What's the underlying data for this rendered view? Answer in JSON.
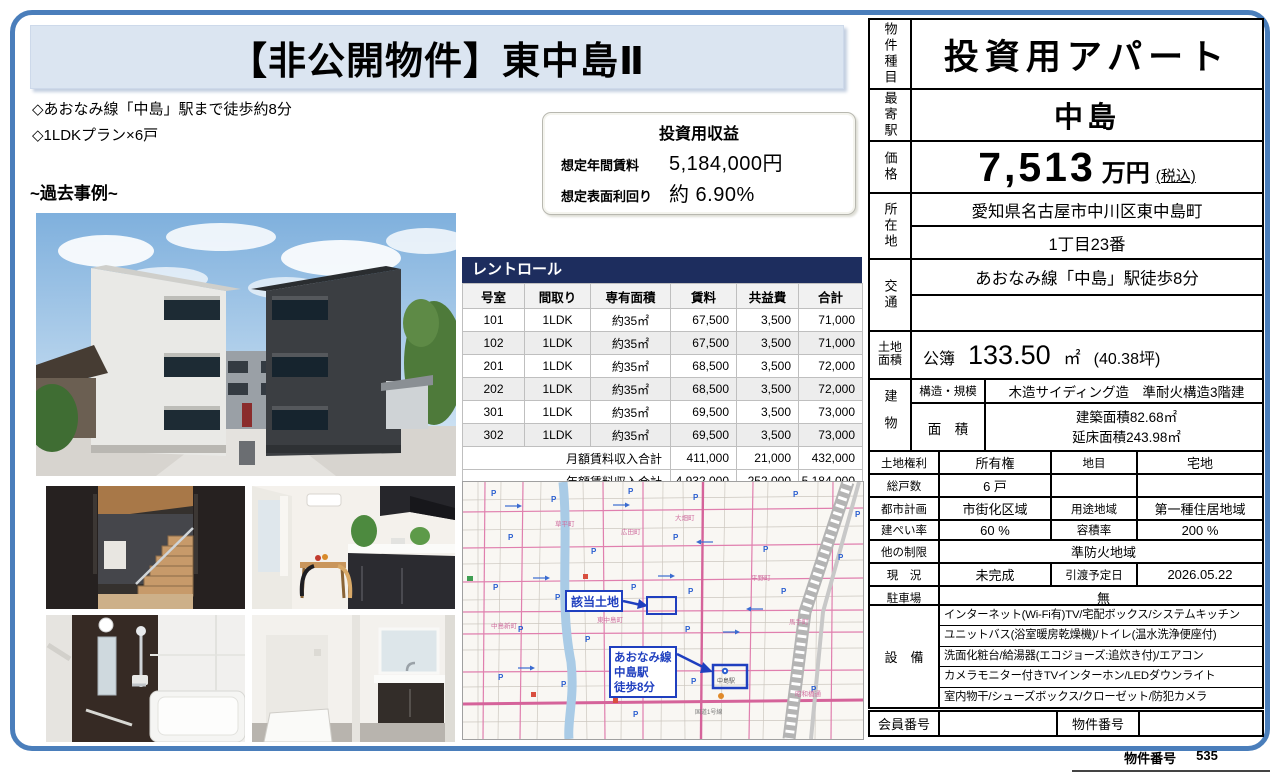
{
  "page": {
    "title": "【非公開物件】東中島Ⅱ",
    "bullets": [
      "◇あおなみ線「中島」駅まで徒歩約8分",
      "◇1LDKプラン×6戸"
    ],
    "past_example_heading": "~過去事例~",
    "footer_label": "物件番号",
    "footer_value": "535"
  },
  "income_box": {
    "title": "投資用収益",
    "annual_rent_label": "想定年間賃料",
    "annual_rent_value": "5,184,000円",
    "yield_label": "想定表面利回り",
    "yield_value": "約 6.90%"
  },
  "rent_roll": {
    "title": "レントロール",
    "columns": [
      "号室",
      "間取り",
      "専有面積",
      "賃料",
      "共益費",
      "合計"
    ],
    "rows": [
      [
        "101",
        "1LDK",
        "約35㎡",
        "67,500",
        "3,500",
        "71,000"
      ],
      [
        "102",
        "1LDK",
        "約35㎡",
        "67,500",
        "3,500",
        "71,000"
      ],
      [
        "201",
        "1LDK",
        "約35㎡",
        "68,500",
        "3,500",
        "72,000"
      ],
      [
        "202",
        "1LDK",
        "約35㎡",
        "68,500",
        "3,500",
        "72,000"
      ],
      [
        "301",
        "1LDK",
        "約35㎡",
        "69,500",
        "3,500",
        "73,000"
      ],
      [
        "302",
        "1LDK",
        "約35㎡",
        "69,500",
        "3,500",
        "73,000"
      ]
    ],
    "monthly_total": [
      "月額賃料収入合計",
      "411,000",
      "21,000",
      "432,000"
    ],
    "annual_total": [
      "年額賃料収入合計",
      "4,932,000",
      "252,000",
      "5,184,000"
    ]
  },
  "map": {
    "site_label": "該当土地",
    "station_note_lines": [
      "あおなみ線",
      "中島駅",
      "徒歩8分"
    ],
    "station_name": "中島駅",
    "parking_glyph": "P",
    "area_labels": [
      "草平町",
      "広田町",
      "大畑町",
      "東中島町",
      "中島新町",
      "平野町",
      "馬手町",
      "昭和橋通",
      "国道1号線"
    ]
  },
  "details": {
    "property_type_label": "物件種目",
    "property_type": "投資用アパート",
    "station_label": "最寄駅",
    "station": "中島",
    "price_label": "価格",
    "price_value": "7,513",
    "price_unit": "万円",
    "price_tax": "(税込)",
    "location_label": "所在地",
    "location_line1": "愛知県名古屋市中川区東中島町",
    "location_line2": "1丁目23番",
    "transport_label": "交通",
    "transport_line1": "あおなみ線「中島」駅徒歩8分",
    "transport_line2": "",
    "land_label": "土地面積",
    "land_register": "公簿",
    "land_value": "133.50",
    "land_unit": "㎡",
    "land_tsubo": "(40.38坪)",
    "building_label": "建物",
    "structure_label": "構造・規模",
    "structure_value": "木造サイディング造　準耐火構造3階建",
    "barea_label": "面　積",
    "barea_line1": "建築面積82.68㎡",
    "barea_line2": "延床面積243.98㎡",
    "rows": [
      {
        "l1": "土地権利",
        "v1": "所有権",
        "l2": "地目",
        "v2": "宅地"
      },
      {
        "l1": "総戸数",
        "v1": "6 戸",
        "l2": "",
        "v2": ""
      },
      {
        "l1": "都市計画",
        "v1": "市街化区域",
        "l2": "用途地域",
        "v2": "第一種住居地域"
      },
      {
        "l1": "建ぺい率",
        "v1": "60 %",
        "l2": "容積率",
        "v2": "200 %"
      },
      {
        "l1": "他の制限",
        "v1": "準防火地域"
      },
      {
        "l1": "現　況",
        "v1": "未完成",
        "l2": "引渡予定日",
        "v2": "2026.05.22"
      },
      {
        "l1": "駐車場",
        "v1": "無"
      },
      {
        "l1": "接道状況",
        "v1": "幅員約7.3m"
      }
    ],
    "equipment_label": "設　備",
    "equipment_lines": [
      "インターネット(Wi-Fi有)TV/宅配ボックス/システムキッチン",
      "ユニットバス(浴室暖房乾燥機)/トイレ(温水洗浄便座付)",
      "洗面化粧台/給湯器(エコジョーズ:追炊き付)/エアコン",
      "カメラモニター付きTVインターホン/LEDダウンライト",
      "室内物干/シューズボックス/クローゼット/防犯カメラ"
    ],
    "member_label": "会員番号",
    "member_value": "",
    "property_no_label": "物件番号",
    "property_no_value": ""
  }
}
